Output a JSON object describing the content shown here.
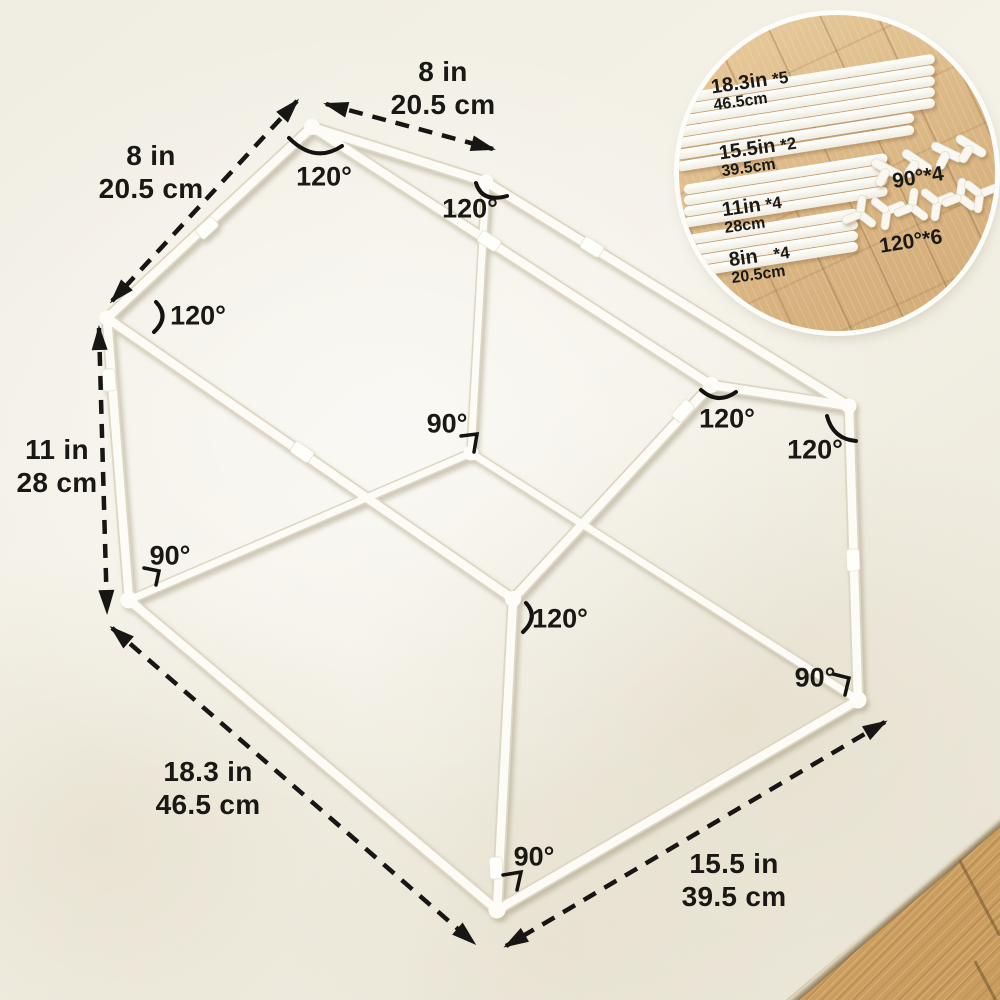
{
  "product_diagram": {
    "description": "play house pipe frame dimension diagram",
    "dimensions": {
      "roof_left_slope": {
        "imperial": "8 in",
        "metric": "20.5 cm"
      },
      "roof_right_slope": {
        "imperial": "8 in",
        "metric": "20.5 cm"
      },
      "wall_height": {
        "imperial": "11 in",
        "metric": "28 cm"
      },
      "base_length": {
        "imperial": "18.3 in",
        "metric": "46.5 cm"
      },
      "base_width": {
        "imperial": "15.5 in",
        "metric": "39.5 cm"
      }
    },
    "angles": [
      {
        "id": "back-gable-peak",
        "label": "120°"
      },
      {
        "id": "back-right-eave",
        "label": "120°"
      },
      {
        "id": "back-left-eave",
        "label": "120°"
      },
      {
        "id": "back-floor-corner",
        "label": "90°"
      },
      {
        "id": "front-gable-peak",
        "label": "120°"
      },
      {
        "id": "right-eave",
        "label": "120°"
      },
      {
        "id": "left-floor-corner",
        "label": "90°"
      },
      {
        "id": "front-eave",
        "label": "120°"
      },
      {
        "id": "right-floor-corner",
        "label": "90°"
      },
      {
        "id": "front-floor-corner",
        "label": "90°"
      }
    ],
    "parts_inset": {
      "pipes": [
        {
          "size_in": "18.3in",
          "qty": "*5",
          "size_cm": "46.5cm",
          "count": 5
        },
        {
          "size_in": "15.5in",
          "qty": "*2",
          "size_cm": "39.5cm",
          "count": 2
        },
        {
          "size_in": "11in",
          "qty": "*4",
          "size_cm": "28cm",
          "count": 4
        },
        {
          "size_in": "8in",
          "qty": "*4",
          "size_cm": "20.5cm",
          "count": 4
        }
      ],
      "connectors": [
        {
          "id": "tee-90",
          "label": "90°*4",
          "count": 4
        },
        {
          "id": "wye-120",
          "label": "120°*6",
          "count": 6
        }
      ]
    },
    "colors": {
      "background": "#f1eee3",
      "pipe": "#fcfbf6",
      "annotation": "#1a1814",
      "wood": "#d9b37e"
    }
  }
}
